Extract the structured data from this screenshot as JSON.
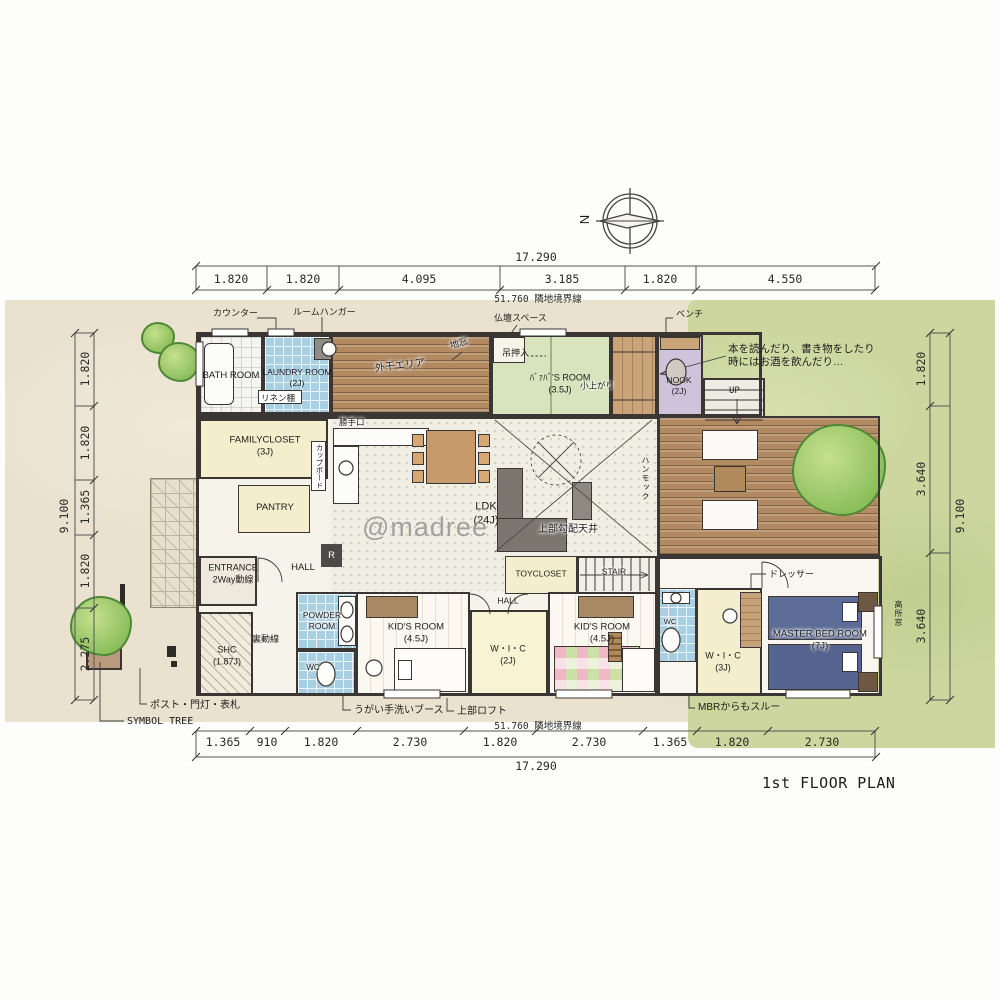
{
  "meta": {
    "title": "1st FLOOR PLAN",
    "watermark": "@madree",
    "compass_n": "N",
    "boundary": "51.760 隣地境界線"
  },
  "dims": {
    "top": {
      "total": "17.290",
      "segments": [
        "1.820",
        "1.820",
        "4.095",
        "3.185",
        "1.820",
        "4.550"
      ]
    },
    "bottom": {
      "total": "17.290",
      "segments": [
        "1.365",
        "910",
        "1.820",
        "2.730",
        "1.820",
        "2.730",
        "1.365",
        "1.820",
        "2.730"
      ]
    },
    "left": {
      "total": "9.100",
      "segments": [
        "1.820",
        "1.820",
        "1.365",
        "1.820",
        "2.275"
      ]
    },
    "right": {
      "total": "9.100",
      "segments": [
        "1.820",
        "3.640",
        "3.640"
      ]
    }
  },
  "rooms": {
    "bath": {
      "label": "BATH ROOM"
    },
    "laundry": {
      "label": "LAUNDRY ROOM",
      "size": "(2J)"
    },
    "drying": {
      "label": "外干エリア"
    },
    "baba": {
      "label": "ﾊﾞｧﾊﾞ'S ROOM",
      "size": "(3.5J)"
    },
    "koagari": {
      "label": "小上がり"
    },
    "nook": {
      "label": "NOOK",
      "size": "(2J)"
    },
    "family_closet": {
      "label": "FAMILYCLOSET",
      "size": "(3J)"
    },
    "pantry": {
      "label": "PANTRY"
    },
    "entrance": {
      "label": "ENTRANCE",
      "size": "2Way動線"
    },
    "hall1": {
      "label": "HALL"
    },
    "shc": {
      "label": "SHC",
      "size": "(1.87J)"
    },
    "powder": {
      "label": "POWDER",
      "label2": "ROOM"
    },
    "wc1": {
      "label": "WC"
    },
    "ldk": {
      "label": "LDK",
      "size": "(24J)"
    },
    "toycloset": {
      "label": "TOYCLOSET"
    },
    "stair": {
      "label": "STAIR"
    },
    "hall2": {
      "label": "HALL"
    },
    "kids1": {
      "label": "KID'S ROOM",
      "size": "(4.5J)"
    },
    "wic2": {
      "label": "W・I・C",
      "size": "(2J)"
    },
    "kids2": {
      "label": "KID'S ROOM",
      "size": "(4.5J)"
    },
    "wc2": {
      "label": "WC"
    },
    "wic3": {
      "label": "W・I・C",
      "size": "(3J)"
    },
    "master": {
      "label": "MASTER BED ROOM",
      "size": "(7J)"
    }
  },
  "ann": {
    "counter": "カウンター",
    "room_hanger": "ルームハンガー",
    "linen_shelf": "リネン棚",
    "kitchen_door": "勝手口",
    "cupboard": "カップボード",
    "butsudan": "仏壇スペース",
    "tsuri_oshiire": "吊押入",
    "jimado": "地窓",
    "bench": "ベンチ",
    "up": "UP",
    "nook_note1": "本を読んだり、書き物をしたり",
    "nook_note2": "時にはお酒を飲んだり…",
    "hammock": "ハンモック",
    "sloped_ceiling": "上部勾配天井",
    "back_line": "裏動線",
    "fridge": "R",
    "gargle_booth": "うがい手洗いブース",
    "loft": "上部ロフト",
    "mbr_through": "MBRからもスルー",
    "post": "ポスト・門灯・表札",
    "symbol_tree": "SYMBOL TREE",
    "dresser": "ドレッサー",
    "high_window": "高所窓"
  }
}
